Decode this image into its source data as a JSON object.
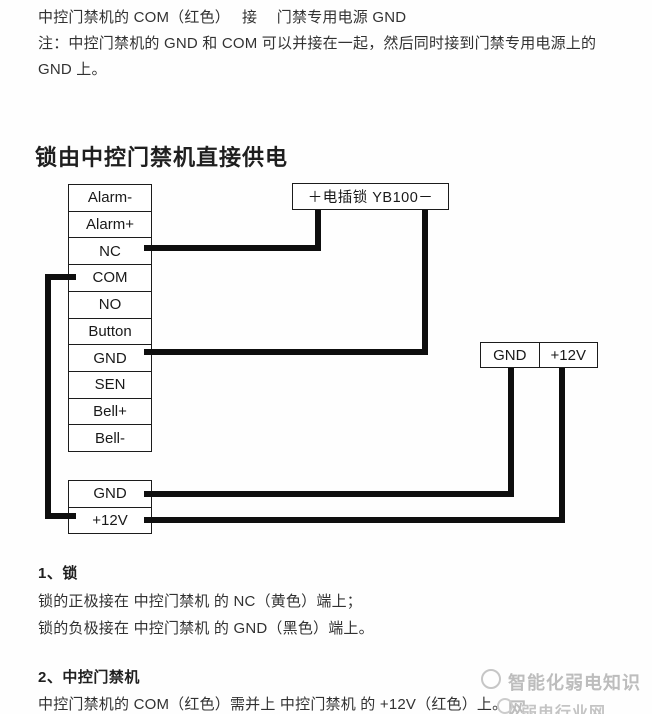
{
  "page": {
    "background": "#fefefe",
    "text_color": "#323232",
    "line_color": "#0e0e0e",
    "border_color": "#1c1c1c",
    "watermark_color": "#bdbdbd"
  },
  "intro": {
    "line1": "中控门禁机的 COM（红色）　 接　 门禁专用电源 GND",
    "line2": "注：中控门禁机的 GND 和 COM 可以并接在一起，然后同时接到门禁专用电源上的",
    "line3": "GND 上。"
  },
  "diagram": {
    "title": "锁由中控门禁机直接供电",
    "controller_terminals": [
      "Alarm-",
      "Alarm+",
      "NC",
      "COM",
      "NO",
      "Button",
      "GND",
      "SEN",
      "Bell+",
      "Bell-"
    ],
    "lock_label": "＋电插锁 YB100－",
    "power_terminals": [
      "GND",
      "+12V"
    ],
    "controller_power_terminals": [
      "GND",
      "+12V"
    ],
    "connections": [
      "NC → 电插锁 +",
      "GND → 电插锁 -",
      "COM → 中控门禁机 +12V",
      "门禁专用电源 GND → 中控门禁机 GND",
      "门禁专用电源 +12V → 中控门禁机 +12V"
    ]
  },
  "notes": {
    "section1_title": "1、锁",
    "section1_line1": "锁的正极接在 中控门禁机 的 NC（黄色）端上；",
    "section1_line2": "锁的负极接在 中控门禁机 的 GND（黑色）端上。",
    "section2_title": "2、中控门禁机",
    "section2_line1": "中控门禁机的 COM（红色）需并上 中控门禁机 的 +12V（红色）上。"
  },
  "watermark": {
    "text": "智能化弱电知识网",
    "subtext": "弱电行业网"
  }
}
